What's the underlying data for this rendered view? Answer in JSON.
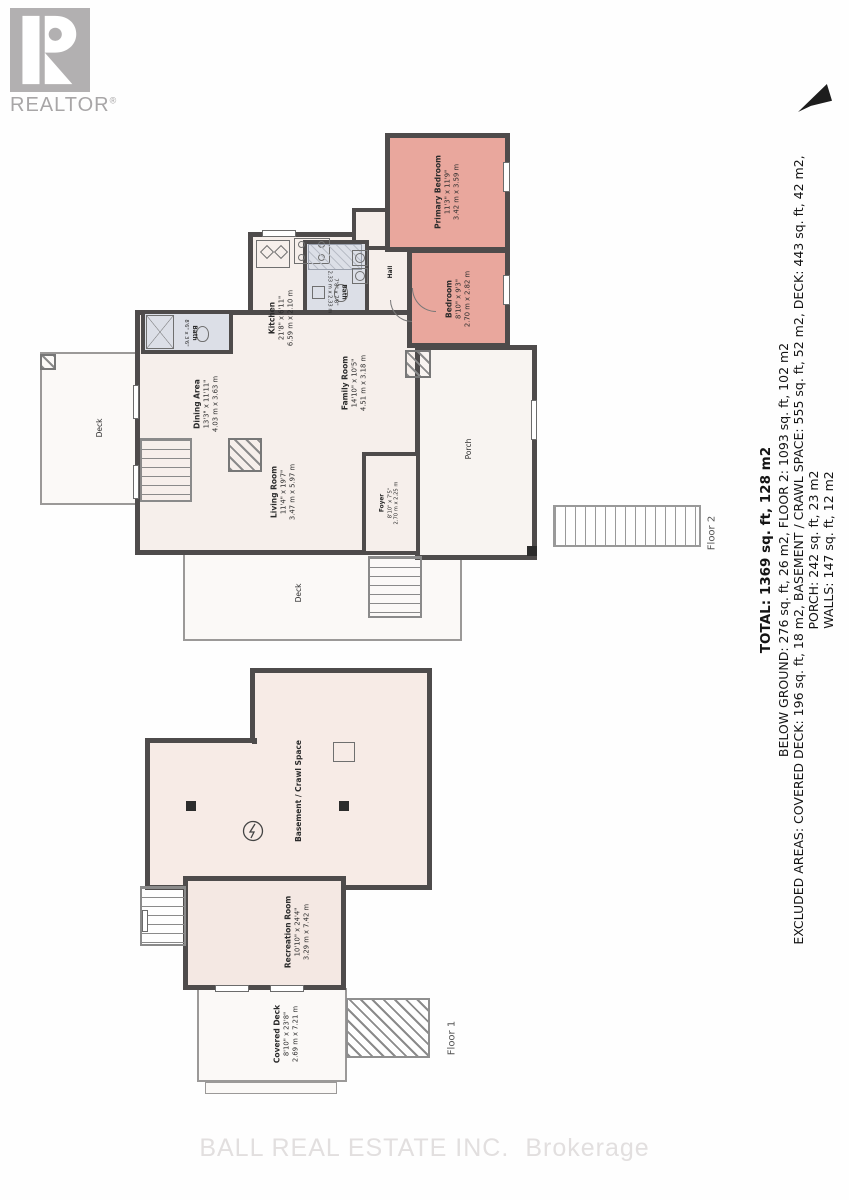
{
  "branding": {
    "logo_letter": "R",
    "logo_word": "REALTOR",
    "registered_mark": "®",
    "watermark_left": "BALL REAL ESTATE INC.",
    "watermark_right": "Brokerage"
  },
  "summary": {
    "total": "TOTAL: 1369 sq. ft, 128 m2",
    "below_ground": "BELOW GROUND: 276 sq. ft, 26 m2, FLOOR 2: 1093 sq. ft, 102 m2",
    "excluded": "EXCLUDED AREAS: COVERED DECK: 196 sq. ft, 18 m2, BASEMENT / CRAWL SPACE: 555 sq. ft, 52 m2, DECK: 443 sq. ft, 42 m2,",
    "porch": "PORCH: 242 sq. ft, 23 m2",
    "walls": "WALLS: 147 sq. ft, 12 m2"
  },
  "colors": {
    "wall": "#4e4b4b",
    "floor_fill": "#f6efeb",
    "bedroom_fill": "#e9a79d",
    "bath_fill": "#dcdfe7",
    "logo_gray": "#b2b0b1"
  },
  "floor2": {
    "label": "Floor 2",
    "rooms": {
      "primary_bedroom": {
        "name": "Primary Bedroom",
        "dim_ft": "11'3\" x 11'9\"",
        "dim_m": "3.42 m x 3.59 m"
      },
      "bedroom": {
        "name": "Bedroom",
        "dim_ft": "8'10\" x 9'3\"",
        "dim_m": "2.70 m x 2.82 m"
      },
      "bath": {
        "name": "Bath",
        "dim_ft": "7'8\" x 7'8\"",
        "dim_m": "2.33 m x 2.33 m"
      },
      "bath2": {
        "name": "Bath",
        "dim_ft": "8'6\" x 3'6\"",
        "dim_m": "2.59 m x 1.07 m"
      },
      "kitchen": {
        "name": "Kitchen",
        "dim_ft": "21'8\" x 6'11\"",
        "dim_m": "6.59 m x 2.10 m"
      },
      "dining": {
        "name": "Dining Area",
        "dim_ft": "13'3\" x 11'11\"",
        "dim_m": "4.03 m x 3.63 m"
      },
      "family": {
        "name": "Family Room",
        "dim_ft": "14'10\" x 10'5\"",
        "dim_m": "4.51 m x 3.18 m"
      },
      "living": {
        "name": "Living Room",
        "dim_ft": "11'4\" x 19'7\"",
        "dim_m": "3.47 m x 5.97 m"
      },
      "foyer": {
        "name": "Foyer",
        "dim_ft": "8'10\" x 7'5\"",
        "dim_m": "2.70 m x 2.25 m"
      },
      "hall": {
        "name": "Hall"
      },
      "porch": {
        "name": "Porch"
      },
      "deck_left": {
        "name": "Deck"
      },
      "deck_bottom": {
        "name": "Deck"
      }
    }
  },
  "floor1": {
    "label": "Floor 1",
    "rooms": {
      "basement": {
        "name": "Basement / Crawl Space"
      },
      "recreation": {
        "name": "Recreation Room",
        "dim_ft": "10'10\" x 24'4\"",
        "dim_m": "3.29 m x 7.42 m"
      },
      "covered_deck": {
        "name": "Covered Deck",
        "dim_ft": "8'10\" x 23'8\"",
        "dim_m": "2.69 m x 7.21 m"
      }
    }
  }
}
